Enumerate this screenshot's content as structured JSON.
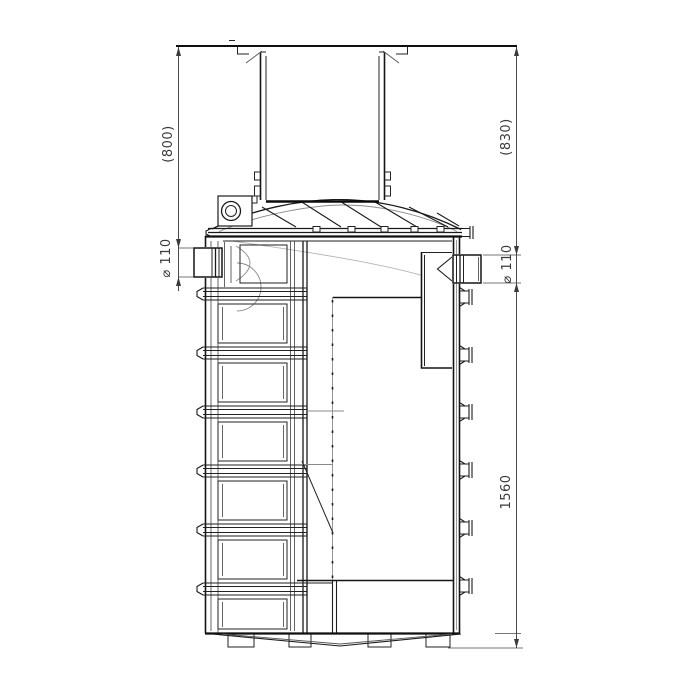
{
  "drawing": {
    "type": "technical-sectional-drawing",
    "dimensions": {
      "riser_height": "(800)",
      "cover_height": "(830)",
      "inlet_diameter": "⌀ 110",
      "outlet_diameter": "⌀ 110",
      "total_height": "1560"
    },
    "colors": {
      "line": "#1a1a1a",
      "dimension": "#4a4a4a",
      "faint": "#b4b4b4",
      "background": "#ffffff"
    }
  }
}
